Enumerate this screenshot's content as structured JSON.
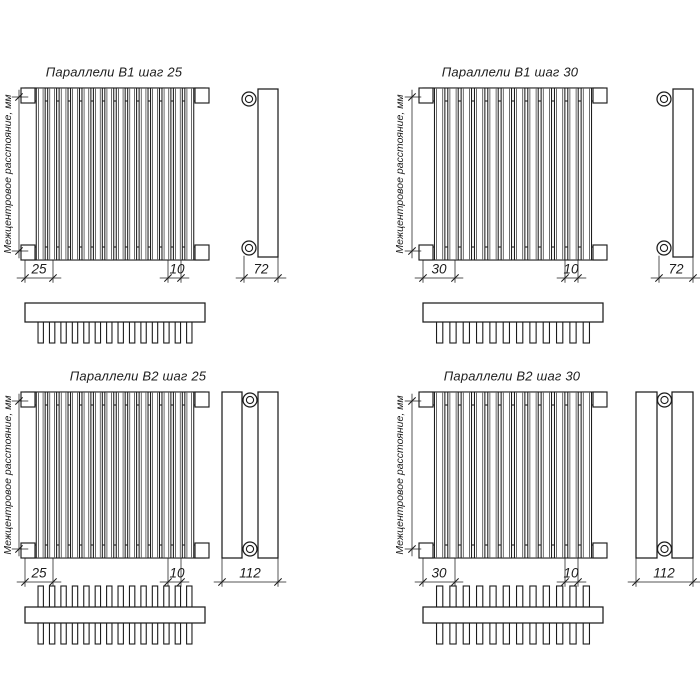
{
  "drawing": {
    "background": "#ffffff",
    "line_color": "#1c1c1c"
  },
  "diagrams": [
    {
      "title": "Параллели В1 шаг 25",
      "vertical_label": "Межцентровое расстояние, мм",
      "pitch_label": "25",
      "tube_width_label": "10",
      "depth_label": "72",
      "tube_count": 14,
      "rows": 1
    },
    {
      "title": "Параллели В1 шаг 30",
      "vertical_label": "Межцентровое расстояние, мм",
      "pitch_label": "30",
      "tube_width_label": "10",
      "depth_label": "72",
      "tube_count": 12,
      "rows": 1
    },
    {
      "title": "Параллели В2 шаг 25",
      "vertical_label": "Межцентровое расстояние, мм",
      "pitch_label": "25",
      "tube_width_label": "10",
      "depth_label": "112",
      "tube_count": 14,
      "rows": 2
    },
    {
      "title": "Параллели В2 шаг 30",
      "vertical_label": "Межцентровое расстояние, мм",
      "pitch_label": "30",
      "tube_width_label": "10",
      "depth_label": "112",
      "tube_count": 12,
      "rows": 2
    }
  ]
}
